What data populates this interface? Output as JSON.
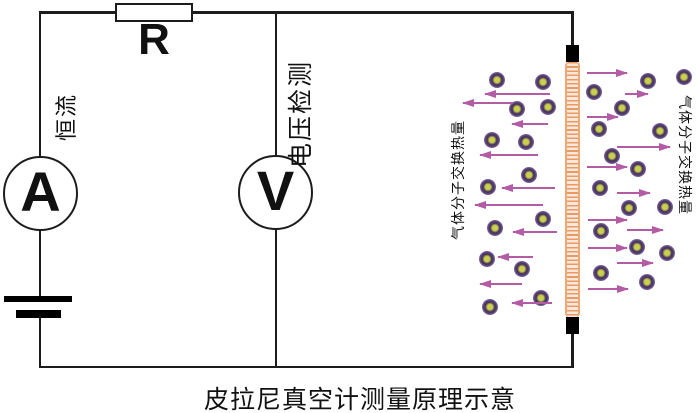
{
  "caption": "皮拉尼真空计测量原理示意",
  "circuit": {
    "ammeter_label": "A",
    "voltmeter_label": "V",
    "resistor_label": "R",
    "constant_current_label": "恒流",
    "voltage_detection_label": "电压检测"
  },
  "gas": {
    "left_label": "气体分子交换热量",
    "right_label": "气体分子交换热量",
    "molecules_left": [
      [
        497,
        80
      ],
      [
        543,
        82
      ],
      [
        517,
        109
      ],
      [
        548,
        107
      ],
      [
        492,
        140
      ],
      [
        526,
        142
      ],
      [
        529,
        175
      ],
      [
        488,
        187
      ],
      [
        543,
        219
      ],
      [
        495,
        228
      ],
      [
        487,
        259
      ],
      [
        522,
        269
      ],
      [
        541,
        298
      ],
      [
        490,
        307
      ]
    ],
    "molecules_right": [
      [
        684,
        77
      ],
      [
        648,
        81
      ],
      [
        594,
        92
      ],
      [
        622,
        108
      ],
      [
        599,
        129
      ],
      [
        660,
        131
      ],
      [
        612,
        156
      ],
      [
        638,
        169
      ],
      [
        600,
        188
      ],
      [
        665,
        207
      ],
      [
        629,
        208
      ],
      [
        601,
        231
      ],
      [
        637,
        247
      ],
      [
        667,
        253
      ],
      [
        601,
        273
      ],
      [
        647,
        282
      ]
    ],
    "arrows_left": [
      [
        485,
        550,
        94
      ],
      [
        463,
        513,
        103
      ],
      [
        512,
        548,
        124
      ],
      [
        480,
        538,
        155
      ],
      [
        502,
        555,
        188
      ],
      [
        475,
        543,
        205
      ],
      [
        513,
        557,
        232
      ],
      [
        498,
        533,
        257
      ],
      [
        480,
        522,
        284
      ],
      [
        512,
        552,
        303
      ]
    ],
    "arrows_right": [
      [
        587,
        627,
        73
      ],
      [
        625,
        648,
        94
      ],
      [
        587,
        618,
        117
      ],
      [
        617,
        670,
        147
      ],
      [
        587,
        627,
        167
      ],
      [
        617,
        650,
        193
      ],
      [
        588,
        627,
        220
      ],
      [
        627,
        663,
        230
      ],
      [
        588,
        627,
        248
      ],
      [
        617,
        653,
        263
      ],
      [
        588,
        628,
        289
      ]
    ]
  },
  "colors": {
    "wire": "#1c1c1c",
    "filament_edge": "#eda876",
    "filament_fill": "#fbe8da",
    "filament_stripe": "#e89a66",
    "molecule_outer": "#473159",
    "molecule_core": "#c8d14f",
    "arrow": "#b35ba5"
  }
}
